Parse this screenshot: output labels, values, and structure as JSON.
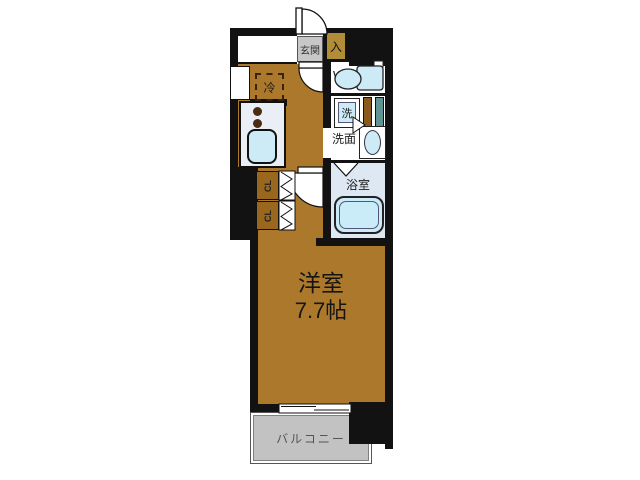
{
  "floorplan": {
    "labels": {
      "genkan": "玄関",
      "entry": "入",
      "wc": "WC",
      "washer": "洗",
      "washroom": "洗面",
      "bathroom": "浴室",
      "closet_upper": "CL",
      "closet_lower": "CL",
      "fridge": "冷",
      "room_name": "洋室",
      "room_size": "7.7帖",
      "balcony": "バルコニー"
    },
    "colors": {
      "wall": "#121212",
      "floor": "#ac782c",
      "closet": "#9a671f",
      "entry_box": "#b28d38",
      "mat": "#c7c7c7",
      "balcony": "#c2c2c2",
      "fixture": "#cdeaf7",
      "bath_bg": "#dde8f2",
      "counter": "#e9eff5",
      "teal_strip": "#5f9492",
      "brown_strip": "#8a5a1d"
    }
  }
}
